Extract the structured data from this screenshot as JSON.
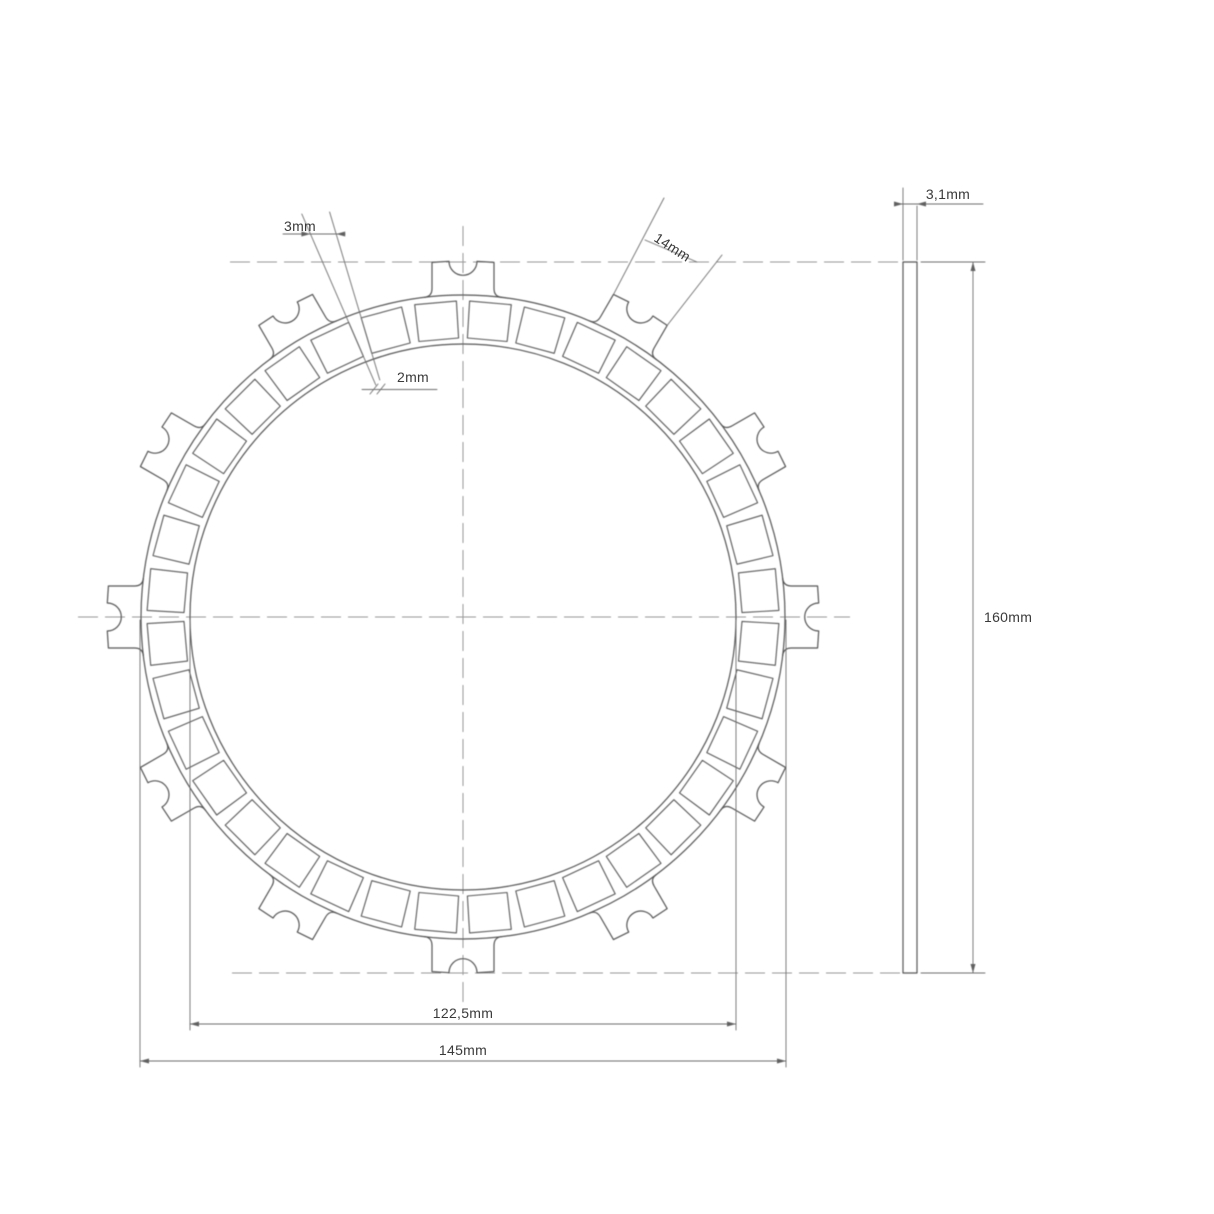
{
  "drawing_title": "clutch friction plate technical drawing",
  "dimensions": {
    "groove_outer": {
      "label": "3mm"
    },
    "groove_inner": {
      "label": "2mm"
    },
    "tab_width": {
      "label": "14mm"
    },
    "thickness": {
      "label": "3,1mm"
    },
    "overall_height": {
      "label": "160mm"
    },
    "inner_diameter": {
      "label": "122,5mm"
    },
    "friction_diameter": {
      "label": "145mm"
    }
  },
  "front_view": {
    "center_x": 463,
    "center_y": 617,
    "ring_outer_radius": 322,
    "ring_inner_radius": 273,
    "tab_tip_radius": 356,
    "tab_half_width": 31,
    "notch_radius": 14,
    "tab_angles_deg": [
      0,
      30,
      60,
      90,
      120,
      150,
      180,
      210,
      240,
      270,
      300,
      330
    ],
    "pad_count": 36,
    "pad_outer_radius": 316,
    "pad_inner_radius": 279,
    "pad_outer_half_deg": 3.8,
    "pad_inner_half_deg": 4.09
  },
  "side_view": {
    "left": 903,
    "top": 262,
    "width": 14,
    "height": 711
  }
}
